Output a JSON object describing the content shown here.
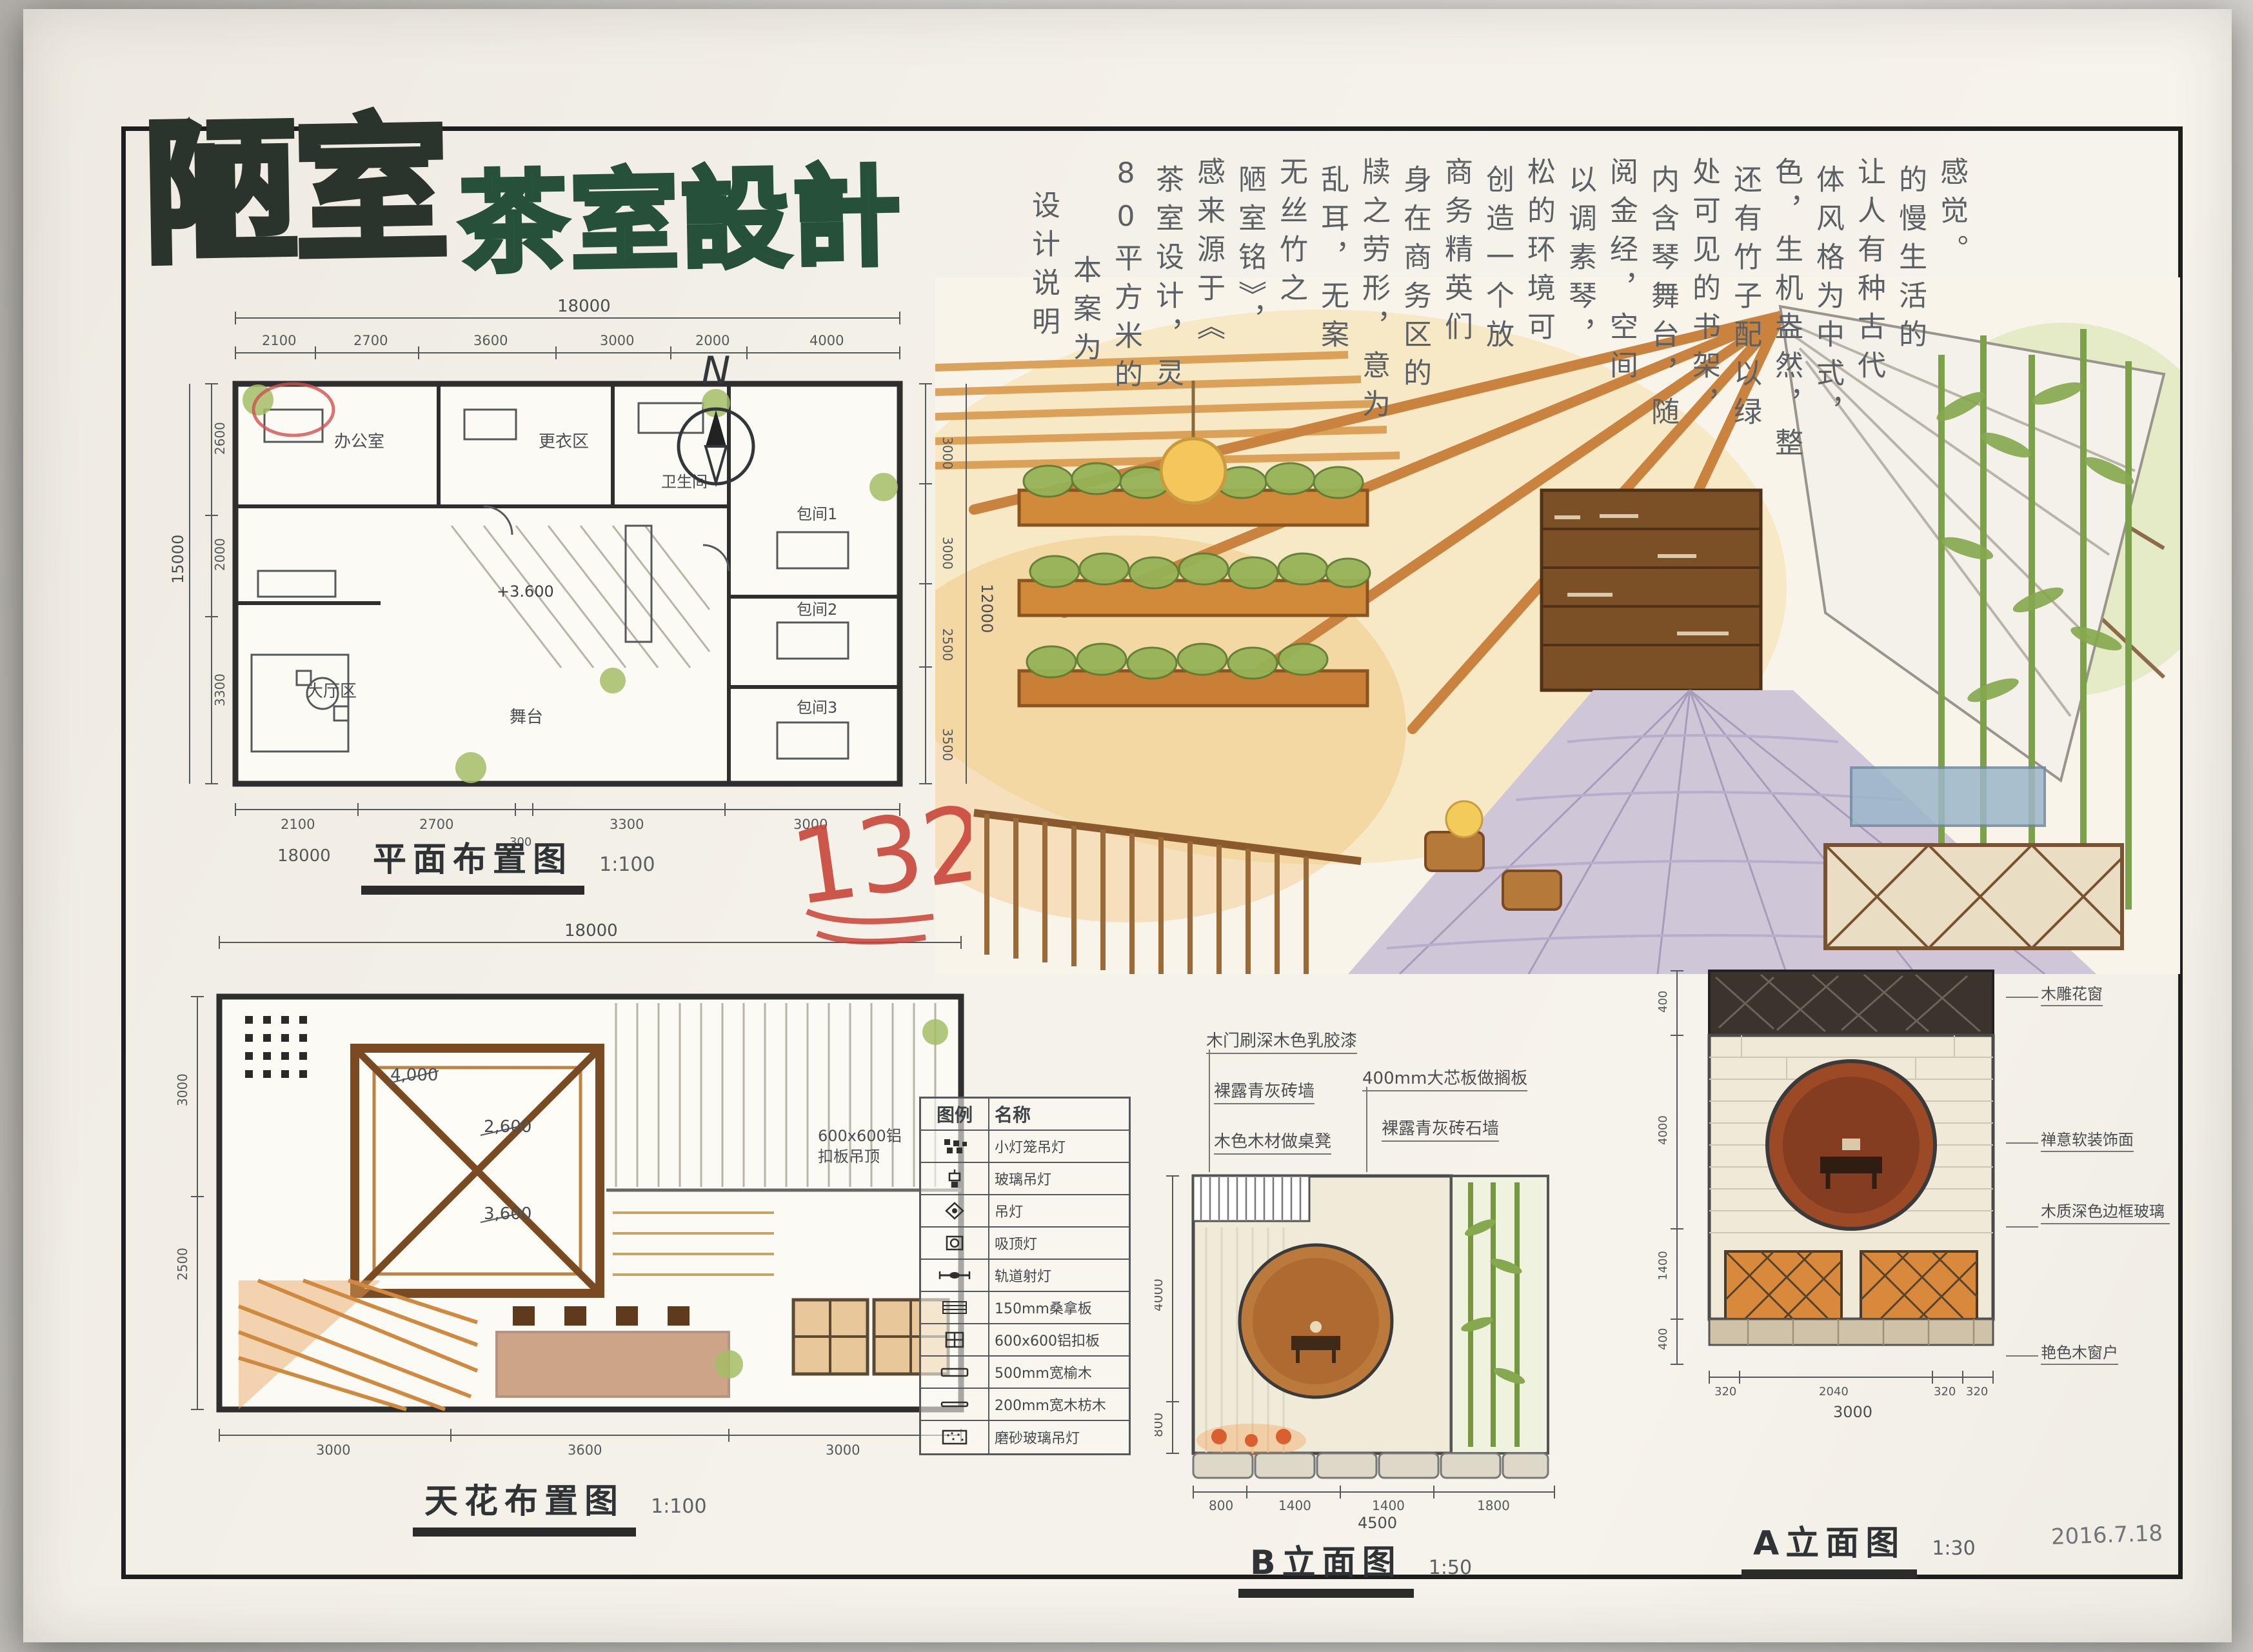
{
  "board": {
    "title_main": "陋室",
    "title_sub": "茶室設計"
  },
  "description": {
    "columns": [
      "设计说明",
      "本案为",
      "80平方米的",
      "茶室设计，灵",
      "感来源于《",
      "陋室铭》，",
      "无丝竹之",
      "乱耳，无案",
      "牍之劳形，意为",
      "身在商务区的",
      "商务精英们",
      "创造一个放",
      "松的环境可",
      "以调素琴，",
      "阅金经，空间",
      "内含琴舞台，随",
      "处可见的书架，",
      "还有竹子配以绿",
      "色，生机盎然，整",
      "体风格为中式，",
      "让人有种古代",
      "的慢生活的",
      "感觉。"
    ]
  },
  "floor_plan": {
    "label": "平面布置图",
    "scale": "1:100",
    "north_label": "N",
    "level_mark": "+3.600",
    "rooms": [
      "办公室",
      "更衣区",
      "卫生间",
      "大厅区",
      "舞台",
      "包间1",
      "包间2",
      "包间3"
    ],
    "dims": {
      "top_total": "18000",
      "top_segments": [
        "2100",
        "2700",
        "3600",
        "3000",
        "2000",
        "4000"
      ],
      "bottom_segments": [
        "2100",
        "2700",
        "300",
        "3300",
        "3000"
      ],
      "bottom_total": "18000",
      "left_total": "15000",
      "left_segments": [
        "2600",
        "2000",
        "3300"
      ],
      "right_segments": [
        "3000",
        "3000",
        "2500",
        "3500"
      ],
      "right_total": "12000"
    }
  },
  "ceiling_plan": {
    "label": "天花布置图",
    "scale": "1:100",
    "callouts": [
      "4,000",
      "2,600",
      "3,600"
    ],
    "panel_note": "600x600铝扣板吊顶",
    "dims": {
      "top_total": "18000",
      "left_segments": [
        "3000",
        "2500"
      ],
      "bottom_segments": [
        "3000",
        "3600",
        "3000"
      ]
    }
  },
  "legend": {
    "header_symbol": "图例",
    "header_name": "名称",
    "rows": [
      {
        "name": "小灯笼吊灯"
      },
      {
        "name": "玻璃吊灯"
      },
      {
        "name": "吊灯"
      },
      {
        "name": "吸顶灯"
      },
      {
        "name": "轨道射灯"
      },
      {
        "name": "150mm桑拿板"
      },
      {
        "name": "600x600铝扣板"
      },
      {
        "name": "500mm宽榆木"
      },
      {
        "name": "200mm宽木枋木"
      },
      {
        "name": "磨砂玻璃吊灯"
      }
    ]
  },
  "elevation_b": {
    "label": "B立面图",
    "scale": "1:50",
    "callouts": [
      "木门刷深木色乳胶漆",
      "裸露青灰砖墙",
      "木色木材做桌凳",
      "400mm大芯板做搁板",
      "裸露青灰砖石墙"
    ],
    "dims": {
      "left": [
        "4000",
        "800"
      ],
      "bottom_segments": [
        "800",
        "1400",
        "1400",
        "1800"
      ],
      "bottom_total": "4500"
    }
  },
  "elevation_a": {
    "label": "A立面图",
    "scale": "1:30",
    "callouts": [
      "木雕花窗",
      "禅意软装饰面",
      "木质深色边框玻璃",
      "艳色木窗户"
    ],
    "dims": {
      "left": [
        "400",
        "4000",
        "1400",
        "400"
      ],
      "bottom_segments": [
        "320",
        "2040",
        "320",
        "320"
      ],
      "bottom_total": "3000"
    }
  },
  "annotations": {
    "red_mark": "132",
    "date": "2016.7.18"
  },
  "colors": {
    "paper": "#f3efe7",
    "frame_ink": "#1e1e1e",
    "title_ink": "#2a342d",
    "title_green": "#2c5c42",
    "handwriting": "#5b6064",
    "marker_orange": "#d68f44",
    "plant_green": "#8fae57",
    "wood_brown": "#a9682f",
    "red_mark": "#c84136"
  }
}
